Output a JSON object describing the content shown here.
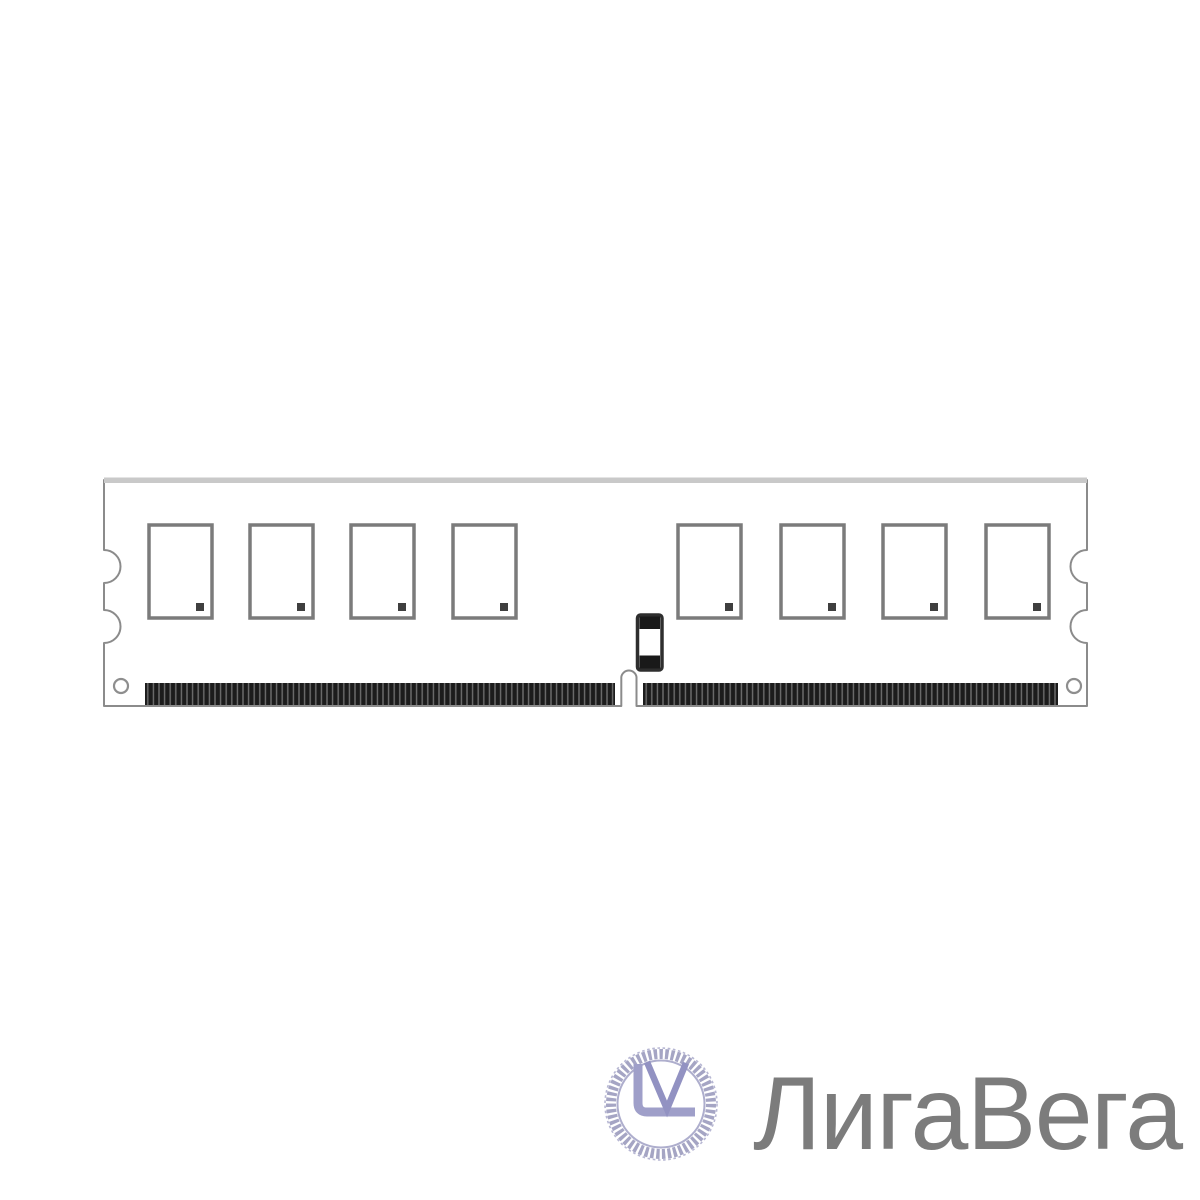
{
  "page": {
    "background_color": "#ffffff"
  },
  "illustration": {
    "type": "memory-module-dimm-line-drawing",
    "chip_count": 8,
    "outline_color": "#8b8b8b",
    "top_edge_color": "#c9c9c9",
    "chip_border_color": "#7b7b7b",
    "chip_dot_color": "#3f3f3f",
    "pin_color": "#1c1c1c",
    "pin_gap_color": "#6e6e6e"
  },
  "watermark": {
    "monogram": "LV",
    "brand_name": "ЛигаВега",
    "logo_ring_color": "#a5a5c4",
    "logo_letter_color": "#9a9ac8",
    "text_color": "#7c7c7c"
  }
}
